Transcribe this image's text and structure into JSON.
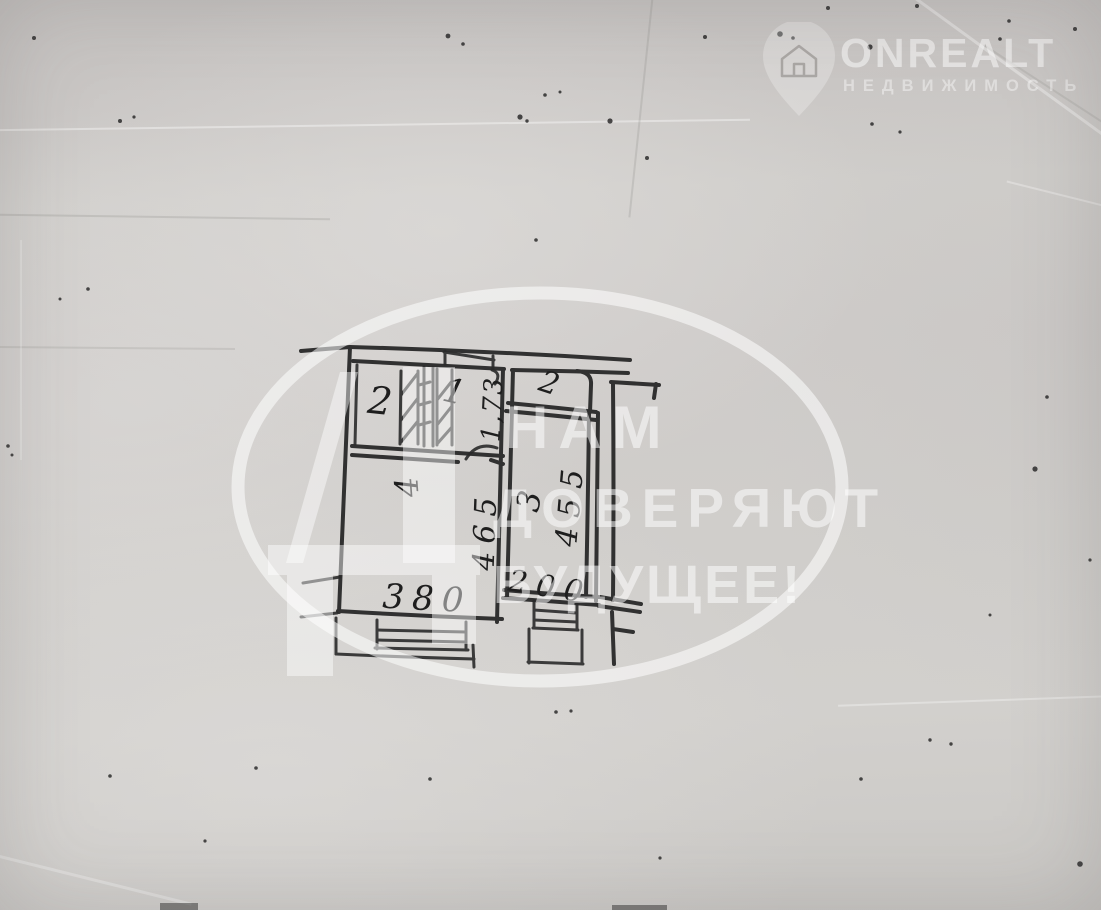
{
  "branding": {
    "logo_text": "ONREALT",
    "logo_subtext": "НЕДВИЖИМОСТЬ",
    "logo_icon": "house-pin-icon",
    "text_color": "#ffffff"
  },
  "watermark": {
    "slogan_line1": "НАМ",
    "slogan_line2": "ДОВЕРЯЮТ",
    "slogan_line3": "БУДУЩЕЕ!",
    "logo_letter": "Д",
    "color": "#ffffff"
  },
  "floor_plan": {
    "description": "hand-drawn apartment floor plan on gray paper",
    "ink_color": "#242424",
    "rooms": [
      {
        "label": "2",
        "position": "top-left"
      },
      {
        "label": "1",
        "position": "top-middle"
      },
      {
        "label": "2",
        "position": "top-right"
      },
      {
        "label": "4",
        "position": "main-center"
      },
      {
        "label": "3",
        "position": "right"
      }
    ],
    "dimensions": [
      {
        "value": "1,73",
        "orientation": "vertical",
        "along": "corridor-depth"
      },
      {
        "value": "465",
        "orientation": "vertical",
        "along": "main-room-depth"
      },
      {
        "value": "455",
        "orientation": "vertical",
        "along": "right-room-depth"
      },
      {
        "value": "380",
        "orientation": "horizontal",
        "along": "main-room-width"
      },
      {
        "value": "200",
        "orientation": "horizontal",
        "along": "right-room-width"
      }
    ]
  },
  "paper": {
    "base_color": "#cbc8c5"
  }
}
